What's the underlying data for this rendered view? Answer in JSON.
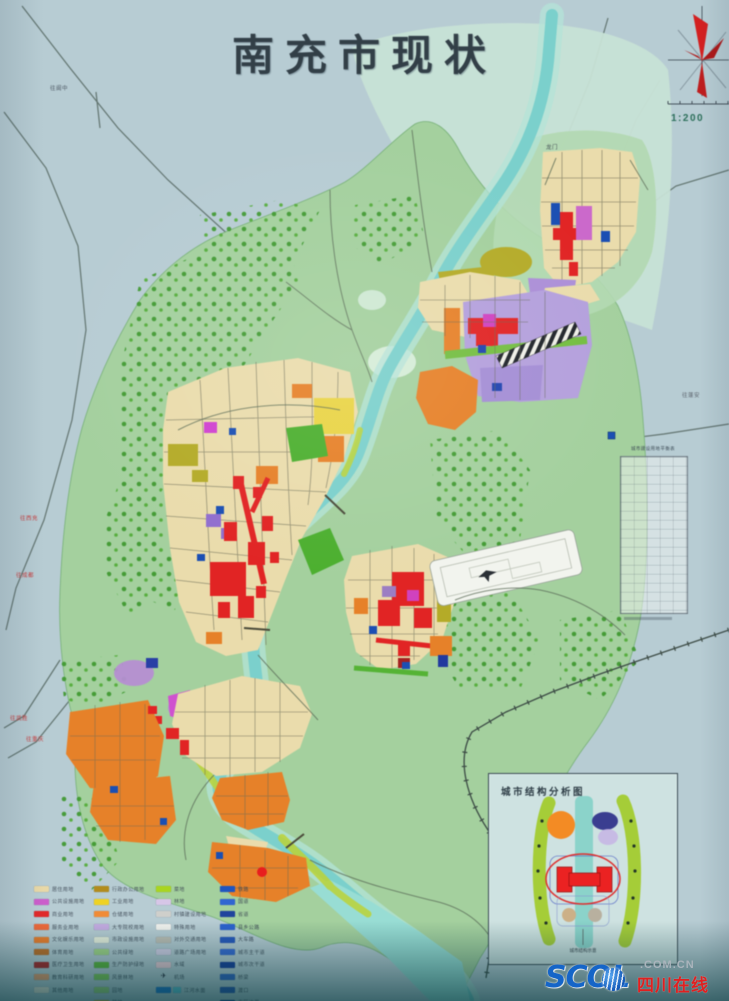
{
  "title": "南充市现状",
  "compass": {
    "scale_label": "1:200"
  },
  "annotation_table": {
    "title": "城市建设用地平衡表"
  },
  "inset": {
    "title": "城市结构分析图",
    "caption": "城市结构示意"
  },
  "watermark": {
    "brand": "SCOL",
    "suffix": ".COM.CN",
    "site": "四川在线"
  },
  "colors": {
    "photo_background": "#b7ccd3",
    "vegetation": "#a5cfa0",
    "pale_valley": "#c8e2d6",
    "river": "#7ecfcb",
    "urban_block": "#e9dcae",
    "industrial_orange": "#e2822e",
    "commercial_red": "#da2626",
    "institutional_purple": "#b3a0da",
    "compass_red": "#cc2222"
  },
  "edge_labels": [
    {
      "text": "往阆中",
      "x": 50,
      "y": 84,
      "c": "#4a5560"
    },
    {
      "text": "龙门",
      "x": 546,
      "y": 143,
      "c": "#3f4a52"
    },
    {
      "text": "往蓬安",
      "x": 682,
      "y": 391,
      "c": "#5a616a"
    },
    {
      "text": "往西充",
      "x": 20,
      "y": 514,
      "c": "#c23b3b"
    },
    {
      "text": "往成都",
      "x": 16,
      "y": 571,
      "c": "#c23b3b"
    },
    {
      "text": "往武胜",
      "x": 10,
      "y": 714,
      "c": "#c23b3b"
    },
    {
      "text": "往重庆",
      "x": 26,
      "y": 735,
      "c": "#c23b3b"
    }
  ],
  "legend": {
    "columns": [
      {
        "items": [
          {
            "sw": "#e7d8a9",
            "label": "居住用地"
          },
          {
            "sw": "#c75fc7",
            "label": "公共设施用地"
          },
          {
            "sw": "#d92b2b",
            "label": "商业用地"
          },
          {
            "sw": "#ea6a3d",
            "label": "服务业用地"
          },
          {
            "sw": "#ea7e2e",
            "label": "文化娱乐用地"
          },
          {
            "sw": "#c07028",
            "label": "体育用地"
          },
          {
            "sw": "#a82424",
            "label": "医疗卫生用地"
          },
          {
            "sw": "#eda06e",
            "label": "教育科研用地"
          },
          {
            "sw": "#efe8d8",
            "label": "其他用地"
          }
        ]
      },
      {
        "items": [
          {
            "sw": "#b08c22",
            "label": "行政办公用地"
          },
          {
            "sw": "#ecd22c",
            "label": "工业用地"
          },
          {
            "sw": "#ec8c3c",
            "label": "仓储用地"
          },
          {
            "sw": "#c3abdf",
            "label": "大专院校用地"
          },
          {
            "sw": "#e7efdd",
            "label": "市政设施用地"
          },
          {
            "sw": "#a8d88a",
            "label": "公共绿地"
          },
          {
            "sw": "#62b83e",
            "label": "生产防护绿地"
          },
          {
            "sw": "#84cc58",
            "label": "风景林地"
          },
          {
            "sw": "#a2d678",
            "label": "园地"
          },
          {
            "sw": "#d9bc3a",
            "label": "耕地"
          }
        ]
      },
      {
        "items": [
          {
            "sw": "#aad428",
            "label": "菜地"
          },
          {
            "sw": "#d6c6e6",
            "label": "林地"
          },
          {
            "sw": "#cfcfcb",
            "label": "村镇建设用地"
          },
          {
            "sw": "#f2f2ee",
            "label": "特殊用地"
          },
          {
            "sw": "#bebeb4",
            "label": "对外交通用地"
          },
          {
            "sw": "#d8d2e8",
            "label": "道路广场用地"
          },
          {
            "sw": "#f0cfd8",
            "label": "水域"
          },
          {
            "glyph": "✈",
            "label": "机场"
          },
          {
            "sw": "#2277cc",
            "sw2": "#66c8d8",
            "label": "江河水面"
          }
        ]
      },
      {
        "items": [
          {
            "sw": "#2255bb",
            "style": "solid",
            "label": "铁路"
          },
          {
            "sw": "#3366cc",
            "style": "dash",
            "label": "国道"
          },
          {
            "sw": "#224499",
            "style": "solid",
            "label": "省道"
          },
          {
            "sw": "#2e62c8",
            "style": "dash",
            "label": "县乡公路"
          },
          {
            "sw": "#2a58b8",
            "style": "solid",
            "label": "大车路"
          },
          {
            "sw": "#3a6ad0",
            "style": "dash",
            "label": "城市主干道"
          },
          {
            "sw": "#1a3d99",
            "style": "solid",
            "label": "城市次干道"
          },
          {
            "sw": "#3566c4",
            "style": "double",
            "label": "桥梁"
          },
          {
            "sw": "#2a55b0",
            "style": "dash",
            "label": "渡口"
          },
          {
            "sw": "#123a8c",
            "style": "solid",
            "label": "市区边界"
          }
        ]
      }
    ]
  }
}
